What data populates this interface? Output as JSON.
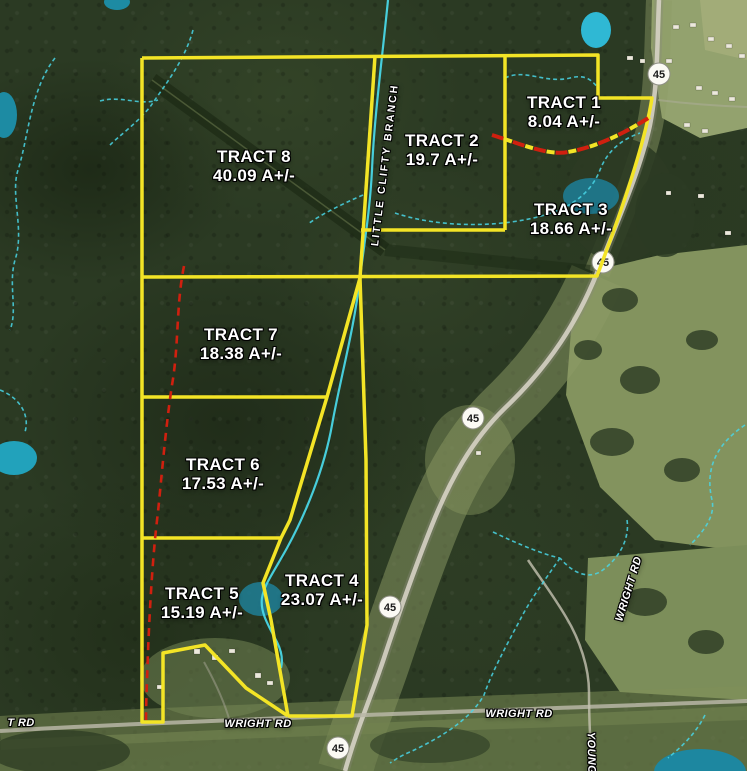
{
  "map": {
    "tracts": [
      {
        "name": "TRACT 1",
        "acreage": "8.04 A+/-"
      },
      {
        "name": "TRACT 2",
        "acreage": "19.7 A+/-"
      },
      {
        "name": "TRACT 3",
        "acreage": "18.66 A+/-"
      },
      {
        "name": "TRACT 4",
        "acreage": "23.07 A+/-"
      },
      {
        "name": "TRACT 5",
        "acreage": "15.19 A+/-"
      },
      {
        "name": "TRACT 6",
        "acreage": "17.53 A+/-"
      },
      {
        "name": "TRACT 7",
        "acreage": "18.38 A+/-"
      },
      {
        "name": "TRACT 8",
        "acreage": "40.09 A+/-"
      }
    ],
    "roads": {
      "highway_route": "45",
      "wright_rd_label": "WRIGHT RD",
      "wright_rd_label_partial": "T RD",
      "young_rd_label": "YOUNG"
    },
    "stream": {
      "name": "LITTLE CLIFTY BRANCH"
    },
    "colors": {
      "boundary_yellow": "#f3e426",
      "easement_red": "#d0200f",
      "stream_cyan": "#49d6e6",
      "pond_teal": "#1f94ad",
      "label_white": "#ffffff"
    }
  }
}
